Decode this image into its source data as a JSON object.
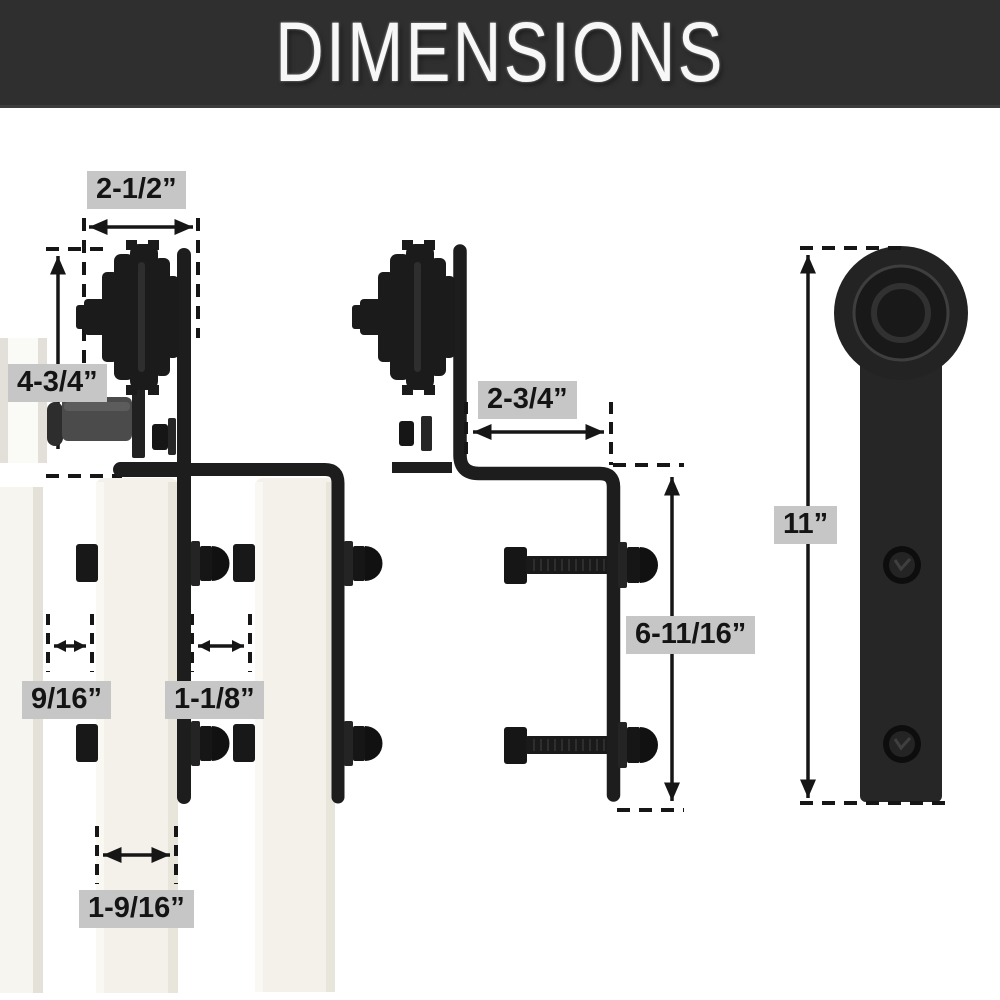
{
  "title": "DIMENSIONS",
  "dimensions": {
    "roller_width": "2-1/2”",
    "roller_height": "4-3/4”",
    "bracket_offset": "2-3/4”",
    "wall_gap": "9/16”",
    "door_gap": "1-1/8”",
    "door_thickness": "1-9/16”",
    "strap_drop": "6-11/16”",
    "hanger_height": "11”"
  },
  "colors": {
    "banner_bg": "#2f2f2f",
    "banner_text": "#f7f7f7",
    "label_bg": "#c6c6c6",
    "hardware_black": "#1d1d1d",
    "spacer_gray": "#4b4b4b",
    "door_cream": "#f3f1e9",
    "background": "#ffffff"
  }
}
